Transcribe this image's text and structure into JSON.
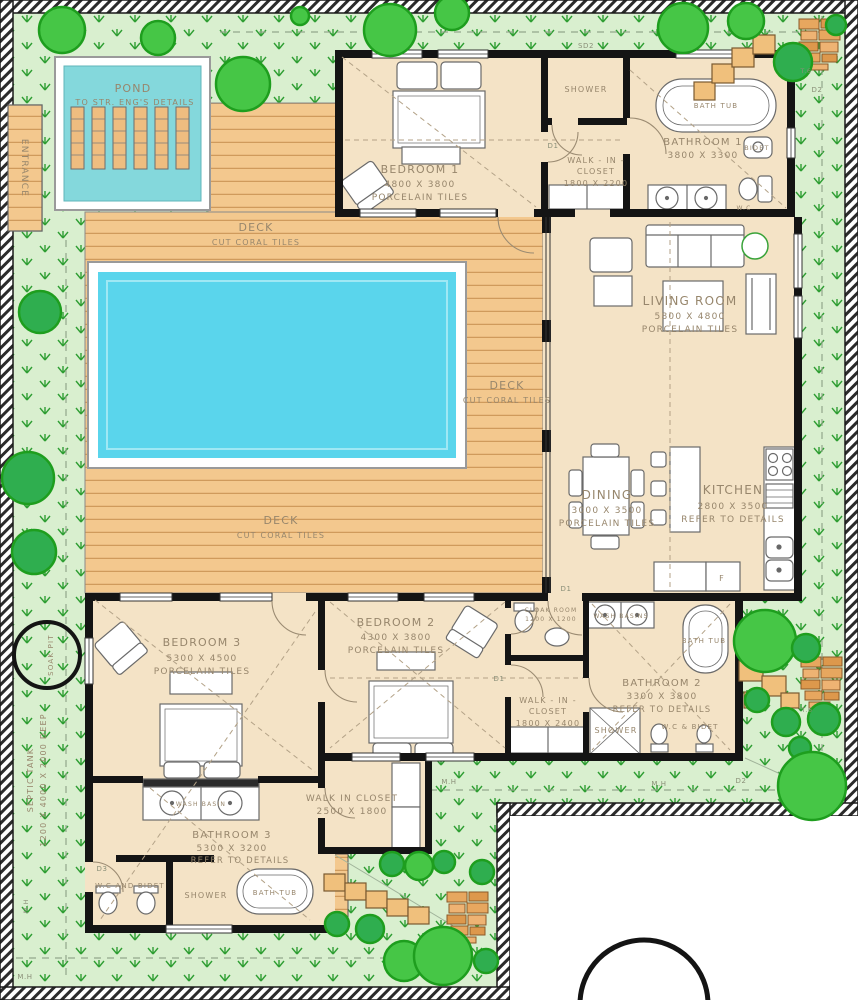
{
  "site": {
    "entrance_label": "ENTRANCE",
    "soak_pit_label": "SOAK PIT",
    "septic_tank_line1": "SEPTIC TANK",
    "septic_tank_line2": "1200 X 4000 X 2000 DEEP",
    "manhole_label": "M.H"
  },
  "tags": {
    "d1": "D1",
    "d2": "D2",
    "d3": "D3",
    "sd2": "SD2",
    "t6": "T.6"
  },
  "pond": {
    "name": "POND",
    "note": "TO STR. ENG'S DETAILS"
  },
  "deck": {
    "name": "DECK",
    "finish": "CUT CORAL TILES"
  },
  "rooms": {
    "bedroom1": {
      "name": "BEDROOM 1",
      "dims": "4800 X 3800",
      "finish": "PORCELAIN TILES"
    },
    "shower1": {
      "name": "SHOWER"
    },
    "wic1": {
      "line1": "WALK - IN -",
      "line2": "CLOSET",
      "dims": "1800 X 2200"
    },
    "bathroom1": {
      "name": "BATHROOM 1",
      "dims": "3800 X 3300"
    },
    "living": {
      "name": "LIVING ROOM",
      "dims": "5800 X 4800",
      "finish": "PORCELAIN TILES"
    },
    "dining": {
      "name": "DINING",
      "dims": "3000 X 3500",
      "finish": "PORCELAIN TILES"
    },
    "kitchen": {
      "name": "KITCHEN",
      "dims": "2800 X 3500",
      "note": "REFER TO DETAILS"
    },
    "cloak": {
      "name": "CLOAK ROOM",
      "dims": "1200 X 1200"
    },
    "bedroom2": {
      "name": "BEDROOM 2",
      "dims": "4300 X 3800",
      "finish": "PORCELAIN TILES"
    },
    "wic2": {
      "line1": "WALK - IN -",
      "line2": "CLOSET",
      "dims": "1800 X 2400"
    },
    "bathroom2": {
      "name": "BATHROOM 2",
      "dims": "3300 X 3800",
      "note": "REFER TO DETAILS"
    },
    "bedroom3": {
      "name": "BEDROOM 3",
      "dims": "5300 X 4500",
      "finish": "PORCELAIN TILES"
    },
    "wic3": {
      "name": "WALK IN CLOSET",
      "dims": "2500 X 1800"
    },
    "bathroom3": {
      "name": "BATHROOM 3",
      "dims": "5300 X 3200",
      "note": "REFER TO DETAILS"
    }
  },
  "fixtures": {
    "bath_tub": "BATH TUB",
    "shower": "SHOWER",
    "bidet": "BIDET",
    "wc": "W.C",
    "wash_basins": "WASH BASINS",
    "wash_basin": "WASH BASIN",
    "wc_and_bidet": "W.C AND BIDET",
    "wc_bidet": "W.C & BIDET",
    "fridge": "F"
  },
  "colors": {
    "garden": "#d9efcf",
    "grass_mark": "#2f9e33",
    "deck_wood": "#f3c88e",
    "pool_water": "#5ad5ec",
    "pond_water": "#84d8dc",
    "floor": "#f4e3c6",
    "tree": "#46c646",
    "wall": "#141414",
    "label": "#97866c"
  }
}
